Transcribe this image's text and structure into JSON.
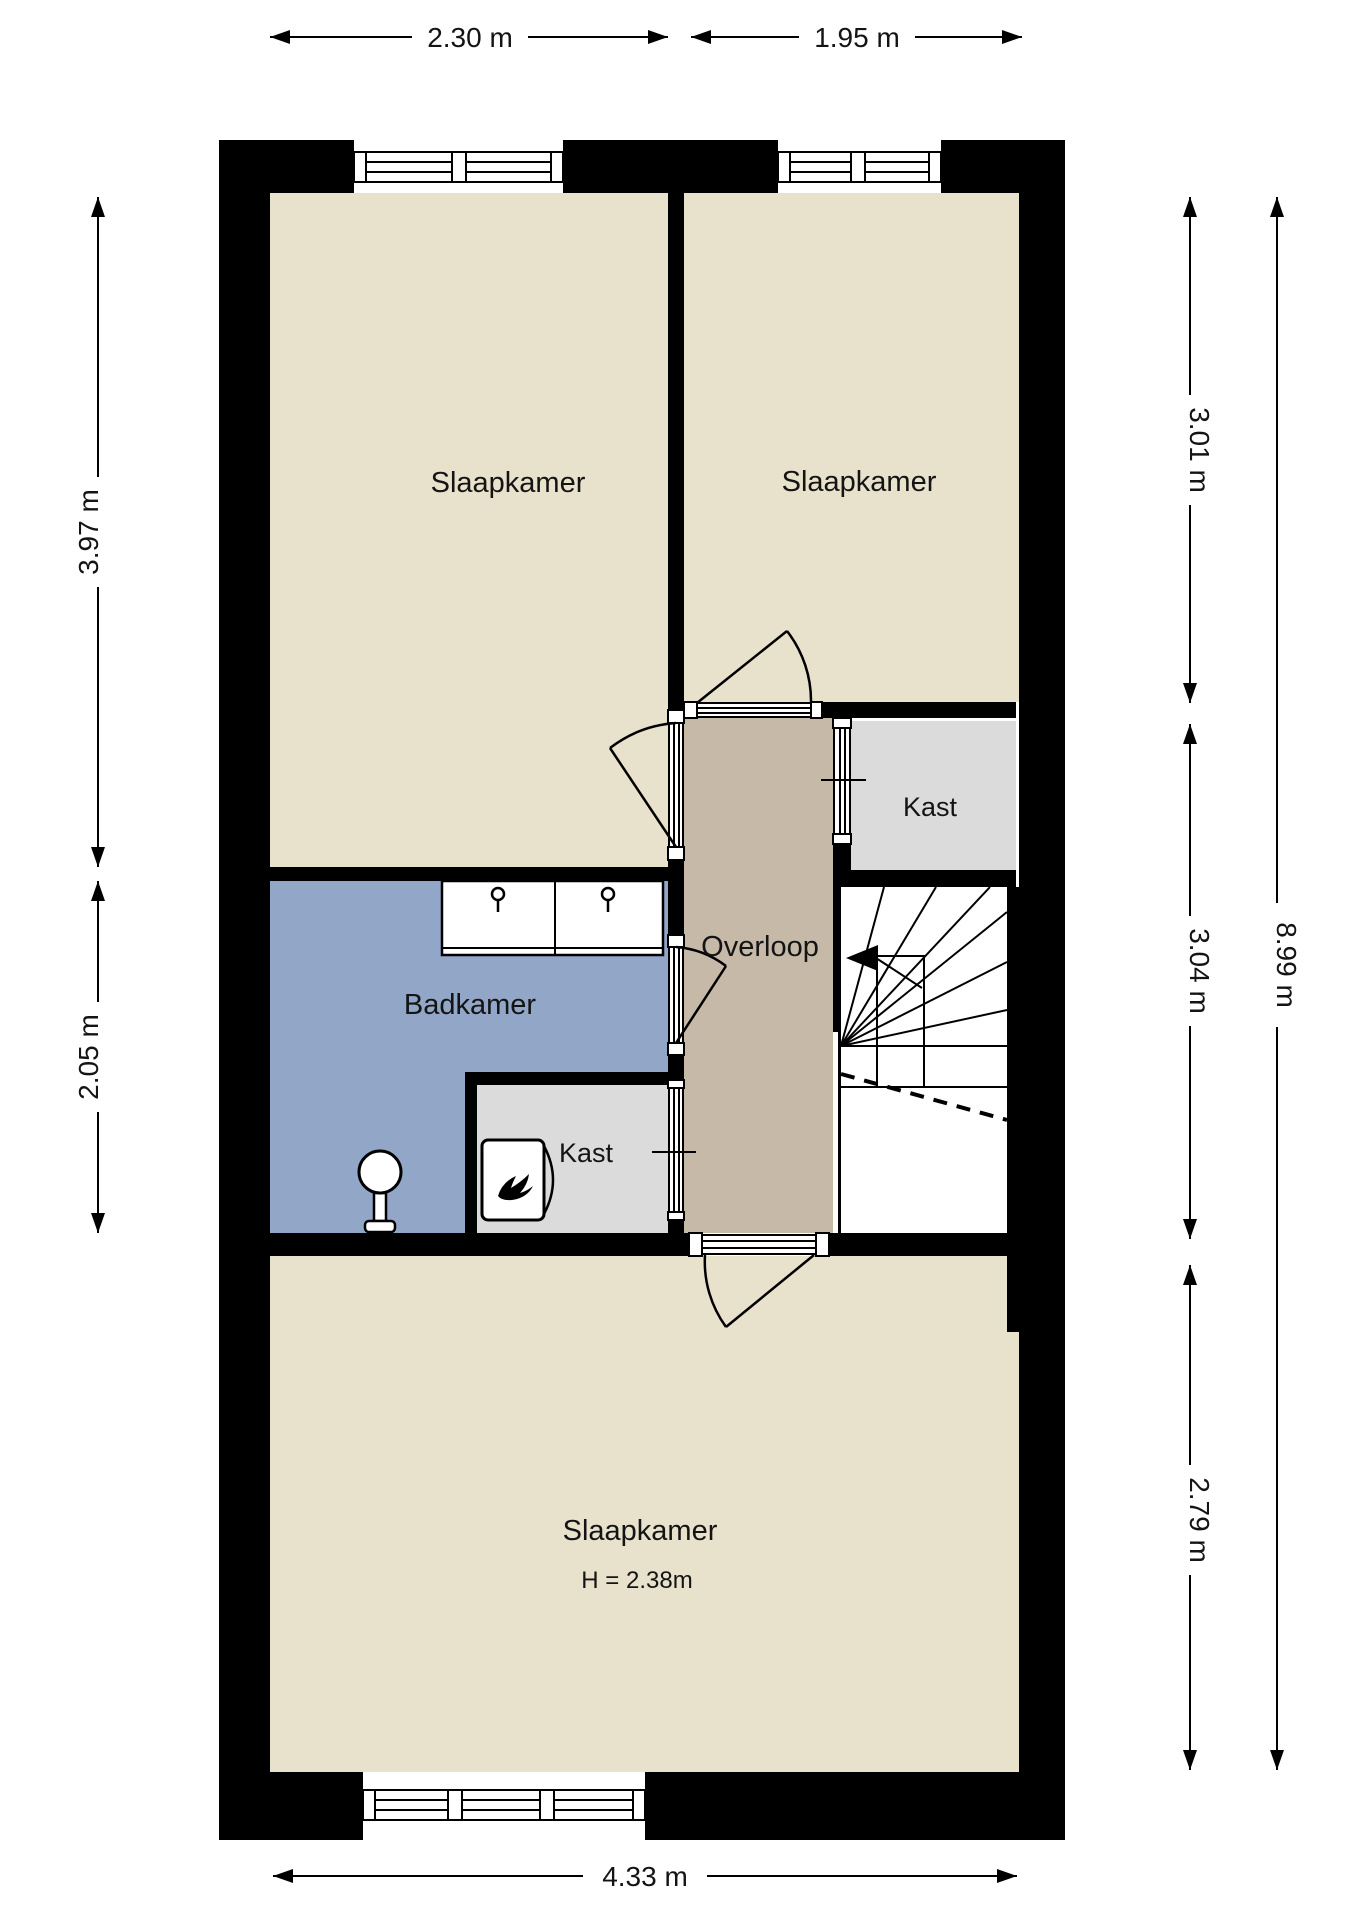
{
  "rooms": {
    "bedroom_top_left": {
      "label": "Slaapkamer"
    },
    "bedroom_top_right": {
      "label": "Slaapkamer"
    },
    "closet_top": {
      "label": "Kast"
    },
    "landing": {
      "label": "Overloop"
    },
    "bathroom": {
      "label": "Badkamer"
    },
    "closet_bottom": {
      "label": "Kast"
    },
    "bedroom_bottom": {
      "label": "Slaapkamer",
      "height_note": "H = 2.38m"
    }
  },
  "dimensions": {
    "top_left": "2.30 m",
    "top_right": "1.95 m",
    "left_upper": "3.97 m",
    "left_lower": "2.05 m",
    "right_upper": "3.01 m",
    "right_middle": "3.04 m",
    "right_lower": "2.79 m",
    "right_total": "8.99 m",
    "bottom": "4.33 m"
  },
  "colors": {
    "wall": "#000000",
    "room_beige": "#e8e1cb",
    "landing_taupe": "#c7b9a7",
    "bathroom_blue": "#92a7c7",
    "closet_gray": "#dbdbdb",
    "stairs_white": "#ffffff",
    "fixture_white": "#ffffff"
  }
}
